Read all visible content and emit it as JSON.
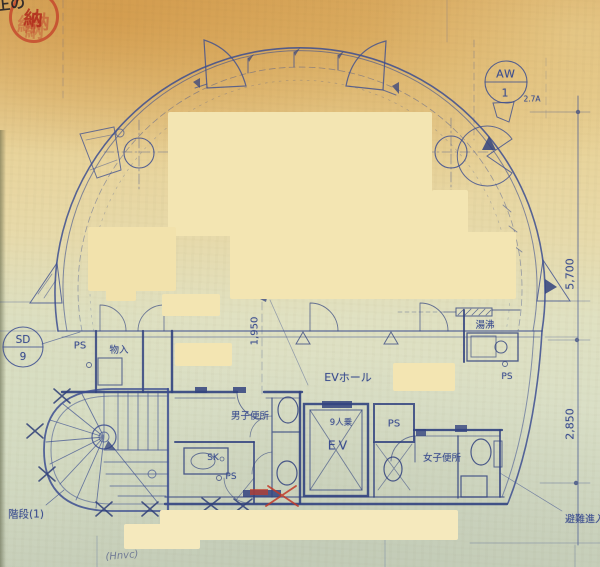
{
  "page": {
    "kind": "scanned architectural floor plan"
  },
  "seal": {
    "text": "納",
    "corner_note": "正の"
  },
  "grid_marks": {
    "aw": {
      "top": "AW",
      "bottom": "1",
      "note": "2.7A"
    },
    "sd": {
      "top": "SD",
      "bottom": "9"
    }
  },
  "rooms": {
    "ev_hall": "EVホール",
    "ev_car": "EV",
    "ev_capacity": "9人乗",
    "mens_toilet": "男子便所",
    "womens_toilet": "女子便所",
    "kitchenette": "湯沸",
    "slop_sink": "SK",
    "storage": "物入",
    "ps_left": "PS",
    "ps_mens": "PS",
    "ps_center": "PS",
    "ps_right": "PS"
  },
  "dimensions": {
    "right_upper": "5,700",
    "right_lower": "2,850",
    "center": "1,950"
  },
  "notes": {
    "stair": "階段(1)",
    "evacuation": "避難進入",
    "handwriting": "(Hnvc)"
  }
}
